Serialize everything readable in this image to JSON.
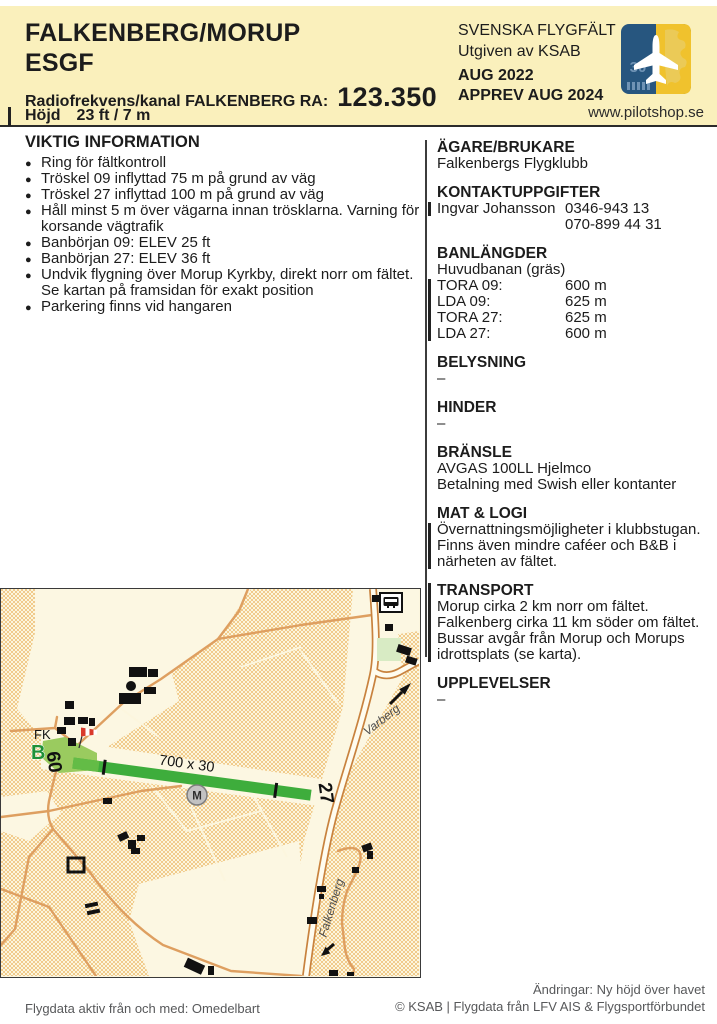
{
  "header": {
    "title_line1": "FALKENBERG/MORUP",
    "title_line2": "ESGF",
    "radio_label": "Radiofrekvens/kanal FALKENBERG RA:",
    "radio_value": "123.350",
    "elevation_label": "Höjd",
    "elevation_value": "23 ft / 7 m",
    "series_title": "SVENSKA FLYGFÄLT",
    "publisher": "Utgiven av KSAB",
    "edition": "AUG 2022",
    "approval": "APPREV AUG 2024",
    "website": "www.pilotshop.se",
    "logo_runway_number": "30"
  },
  "important_info": {
    "heading": "VIKTIG INFORMATION",
    "items": [
      "Ring för fältkontroll",
      "Tröskel 09 inflyttad 75 m på grund av väg",
      "Tröskel 27 inflyttad 100 m på grund av väg",
      "Håll minst 5 m över vägarna innan trösklarna. Varning för korsande vägtrafik",
      "Banbörjan 09: ELEV 25 ft",
      "Banbörjan 27: ELEV 36 ft",
      "Undvik flygning över Morup Kyrkby, direkt norr om fältet. Se kartan på framsidan för exakt position",
      "Parkering finns vid hangaren"
    ]
  },
  "sections": {
    "agare": {
      "heading": "ÄGARE/BRUKARE",
      "line1": "Falkenbergs Flygklubb"
    },
    "kontakt": {
      "heading": "KONTAKTUPPGIFTER",
      "name": "Ingvar Johansson",
      "phone1": "0346-943 13",
      "phone2": "070-899 44 31"
    },
    "banlangder": {
      "heading": "BANLÄNGDER",
      "subheading": "Huvudbanan (gräs)",
      "rows": [
        {
          "label": "TORA 09:",
          "value": "600 m"
        },
        {
          "label": "LDA 09:",
          "value": "625 m"
        },
        {
          "label": "TORA 27:",
          "value": "625 m"
        },
        {
          "label": "LDA 27:",
          "value": "600 m"
        }
      ]
    },
    "belysning": {
      "heading": "BELYSNING",
      "value": "–"
    },
    "hinder": {
      "heading": "HINDER",
      "value": "–"
    },
    "bransle": {
      "heading": "BRÄNSLE",
      "line1": "AVGAS 100LL Hjelmco",
      "line2": "Betalning med Swish eller kontanter"
    },
    "mat_logi": {
      "heading": "MAT & LOGI",
      "text": "Övernattningsmöjligheter i klubbstugan. Finns även mindre caféer och B&B i närheten av fältet."
    },
    "transport": {
      "heading": "TRANSPORT",
      "text": "Morup cirka 2 km norr om fältet. Falkenberg cirka 11 km söder om fältet. Bussar avgår från Morup och Morups idrottsplats (se karta)."
    },
    "upplevelser": {
      "heading": "UPPLEVELSER",
      "value": "–"
    }
  },
  "map": {
    "runway_dimensions": "700 x 30",
    "rwy09": "09",
    "rwy27": "27",
    "fk_label": "FK",
    "bus_stop_label": "B",
    "marker_m": "M",
    "road_north": "Varberg",
    "road_south": "Falkenberg"
  },
  "footer": {
    "valid_from": "Flygdata aktiv från och med: Omedelbart",
    "changes": "Ändringar: Ny höjd över havet",
    "copyright": "© KSAB | Flygdata från LFV AIS & Flygsportförbundet"
  },
  "colors": {
    "header_bg": "#faf0bc",
    "runway_green": "#3ead3c",
    "threshold_green": "#9acb5f",
    "map_cream": "#fcf6de",
    "map_field_orange": "#f1cb8c",
    "road_orange": "#de9f60",
    "major_road_casing": "#c8823e",
    "building_black": "#111111",
    "windsock_red": "#d93a2b",
    "logo_blue": "#27567f",
    "logo_yellow": "#f0c22d"
  }
}
